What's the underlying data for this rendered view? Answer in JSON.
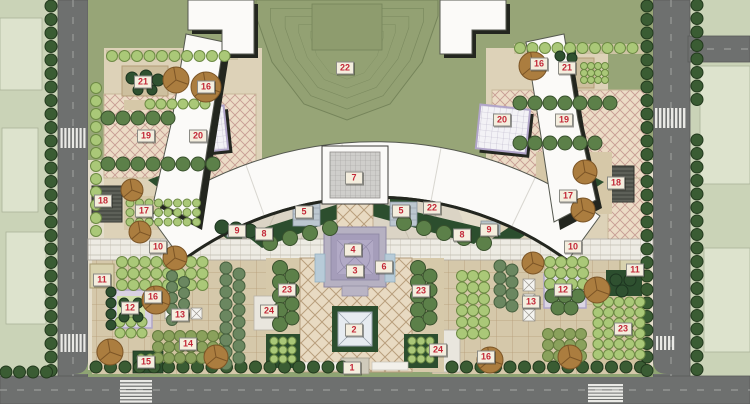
{
  "canvas": {
    "width": 750,
    "height": 404
  },
  "colors": {
    "context": "#cad3b7",
    "context_building": "#e1e6d1",
    "context_line": "#a6ae94",
    "road": "#6e706f",
    "road_edge": "#595b5a",
    "road_dash": "#9a9c9a",
    "crosswalk": "#e9e9e5",
    "verge": "#8fa473",
    "lawn": "#97a577",
    "lawn_fan": "#93a173",
    "lawn_line": "#75845a",
    "site_base": "#e4ddca",
    "garden_base": "#ddd2b8",
    "quadrant_base": "#d5c8aa",
    "lattice_bg": "#ecdcc6",
    "lattice_line": "#c79d94",
    "plaza_bg": "#e8dac2",
    "plaza_line": "#b99f7d",
    "walk_bg": "#edebe3",
    "walk_line": "#c2bdb0",
    "ring_bg": "#dbd4c5",
    "ring_line": "#c8c1b0",
    "hedge_dark": "#2c4e2e",
    "white_plaza": "#f3f2f6",
    "white_plaza_border": "#b1a5c9",
    "pergola": "#4c4f48",
    "pergola_stripe": "#777b70",
    "building_white": "#fbfaf8",
    "building_shadow": "#23261f",
    "building_line": "#55584f",
    "pavilion_roof": "#cfcecb",
    "steps_blue": "#bcc7d0",
    "water": "#b7cbd8",
    "platform_outer": "#b6b1c2",
    "platform_mid": "#a59dba",
    "platform_inner": "#b2aac6",
    "platform_edge": "#8d87a3",
    "pyramid_face": "#e6ebf0",
    "pyramid_line": "#98a2ac",
    "paved_light": "#e9e6de",
    "kiosk": "#d8d2ae",
    "purple_court": "#d9d2e2",
    "court_green": "#cfe0a8",
    "tree_street": "#3a5c33",
    "tree_street_edge": "#22391d",
    "tree_light": "#aac878",
    "tree_light_edge": "#6d8a44",
    "tree_medium": "#5c8049",
    "tree_medium_edge": "#39512d",
    "tree_dark": "#2f5130",
    "tree_dark_edge": "#1d3520",
    "tree_olive": "#8aa15c",
    "tree_olive_edge": "#647a3e",
    "tree_grey": "#6b8760",
    "tree_grey_edge": "#46603f",
    "tree_brown": "#ab7d3f",
    "tree_brown_edge": "#7c5526",
    "marker_bg": "#f4eede",
    "marker_border": "#8b8b85",
    "marker_text": "#c22737"
  },
  "markers": [
    {
      "label": "22",
      "x": 345,
      "y": 68
    },
    {
      "label": "21",
      "x": 143,
      "y": 82
    },
    {
      "label": "16",
      "x": 206,
      "y": 87
    },
    {
      "label": "19",
      "x": 146,
      "y": 136
    },
    {
      "label": "20",
      "x": 198,
      "y": 136
    },
    {
      "label": "16",
      "x": 539,
      "y": 64
    },
    {
      "label": "21",
      "x": 567,
      "y": 68
    },
    {
      "label": "20",
      "x": 502,
      "y": 120
    },
    {
      "label": "19",
      "x": 564,
      "y": 120
    },
    {
      "label": "18",
      "x": 103,
      "y": 201
    },
    {
      "label": "17",
      "x": 144,
      "y": 211
    },
    {
      "label": "17",
      "x": 568,
      "y": 196
    },
    {
      "label": "18",
      "x": 616,
      "y": 183
    },
    {
      "label": "9",
      "x": 237,
      "y": 231
    },
    {
      "label": "8",
      "x": 264,
      "y": 234
    },
    {
      "label": "9",
      "x": 489,
      "y": 230
    },
    {
      "label": "8",
      "x": 462,
      "y": 235
    },
    {
      "label": "5",
      "x": 304,
      "y": 212
    },
    {
      "label": "5",
      "x": 401,
      "y": 211
    },
    {
      "label": "7",
      "x": 354,
      "y": 178
    },
    {
      "label": "22",
      "x": 432,
      "y": 208
    },
    {
      "label": "4",
      "x": 353,
      "y": 250
    },
    {
      "label": "3",
      "x": 355,
      "y": 271
    },
    {
      "label": "6",
      "x": 384,
      "y": 267
    },
    {
      "label": "10",
      "x": 158,
      "y": 247
    },
    {
      "label": "10",
      "x": 573,
      "y": 247
    },
    {
      "label": "23",
      "x": 287,
      "y": 290
    },
    {
      "label": "23",
      "x": 421,
      "y": 291
    },
    {
      "label": "24",
      "x": 269,
      "y": 311
    },
    {
      "label": "24",
      "x": 438,
      "y": 350
    },
    {
      "label": "2",
      "x": 354,
      "y": 330
    },
    {
      "label": "1",
      "x": 352,
      "y": 368
    },
    {
      "label": "11",
      "x": 102,
      "y": 280
    },
    {
      "label": "12",
      "x": 130,
      "y": 308
    },
    {
      "label": "16",
      "x": 153,
      "y": 297
    },
    {
      "label": "13",
      "x": 180,
      "y": 315
    },
    {
      "label": "14",
      "x": 188,
      "y": 344
    },
    {
      "label": "15",
      "x": 146,
      "y": 362
    },
    {
      "label": "11",
      "x": 635,
      "y": 270
    },
    {
      "label": "12",
      "x": 563,
      "y": 290
    },
    {
      "label": "13",
      "x": 531,
      "y": 302
    },
    {
      "label": "23",
      "x": 623,
      "y": 329
    },
    {
      "label": "16",
      "x": 486,
      "y": 357
    }
  ]
}
